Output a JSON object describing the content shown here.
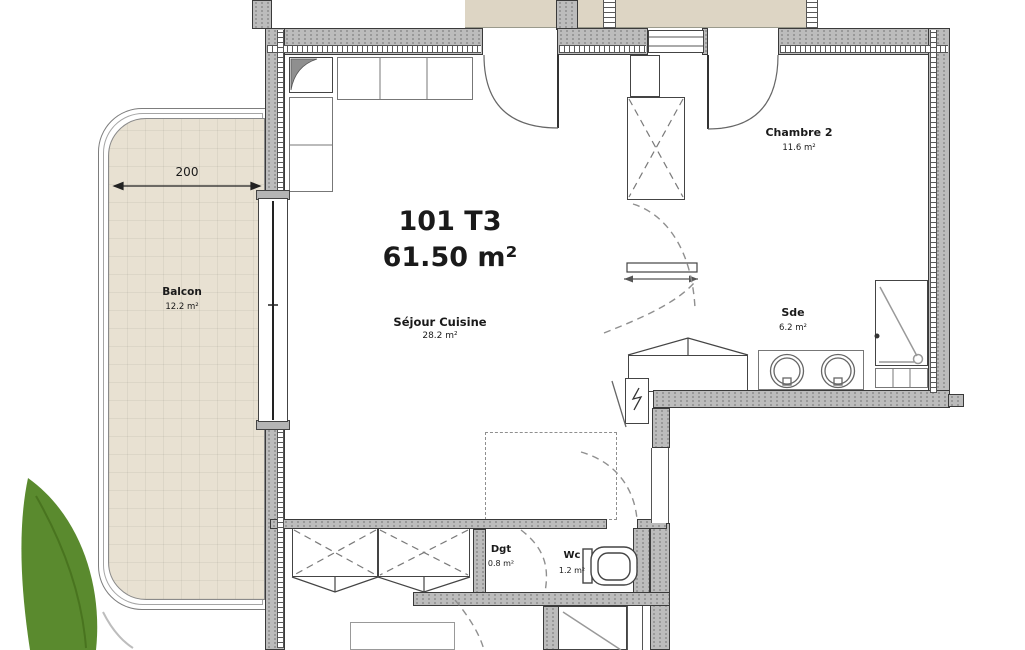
{
  "plan_title": {
    "unit": "101 T3",
    "area": "61.50 m²"
  },
  "dimension": {
    "balcony_width": "200"
  },
  "rooms": {
    "balcon": {
      "name": "Balcon",
      "area": "12.2 m²"
    },
    "sejour": {
      "name": "Séjour Cuisine",
      "area": "28.2 m²"
    },
    "chambre2": {
      "name": "Chambre 2",
      "area": "11.6 m²"
    },
    "sde": {
      "name": "Sde",
      "area": "6.2 m²"
    },
    "dgt": {
      "name": "Dgt",
      "area": "0.8 m²"
    },
    "wc": {
      "name": "Wc",
      "area": "1.2 m²"
    }
  },
  "colors": {
    "balcony_floor": "#e8e1d2",
    "terrace_floor": "#ddd5c4",
    "wall_fill": "#bcbcbc",
    "wall_outline": "#3a3a3a",
    "leaf_green": "#5a8a2e",
    "leaf_vein": "#49741f"
  }
}
